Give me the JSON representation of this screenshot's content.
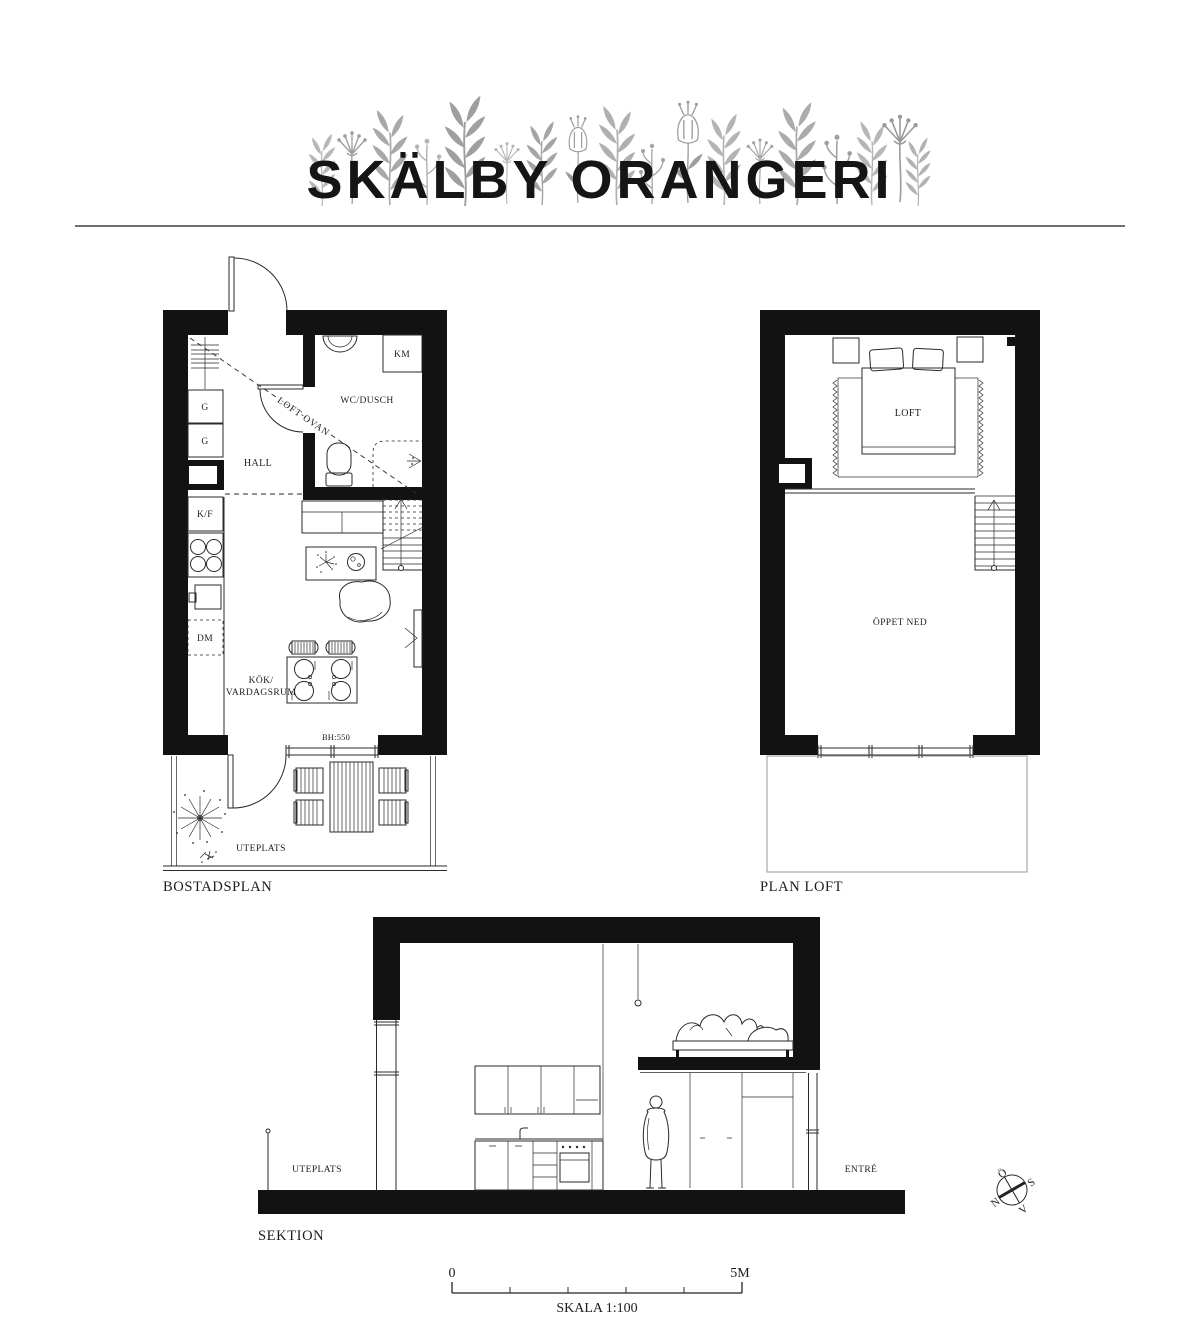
{
  "header": {
    "title": "SKÄLBY ORANGERI"
  },
  "bostadsplan": {
    "caption": "BOSTADSPLAN",
    "labels": {
      "hall": "HALL",
      "wc_dusch": "WC/DUSCH",
      "km": "KM",
      "g_upper": "G",
      "g_lower": "G",
      "kf": "K/F",
      "dm": "DM",
      "loft_ovan": "LOFT OVAN",
      "kok_line1": "KÖK/",
      "kok_line2": "VARDAGSRUM",
      "bh": "BH:550",
      "uteplats": "UTEPLATS"
    }
  },
  "plan_loft": {
    "caption": "PLAN LOFT",
    "labels": {
      "loft": "LOFT",
      "oppet_ned": "ÖPPET NED"
    }
  },
  "sektion": {
    "caption": "SEKTION",
    "labels": {
      "uteplats": "UTEPLATS",
      "entre": "ENTRÉ"
    }
  },
  "compass": {
    "north": "N",
    "south": "S",
    "east": "Ö",
    "west": "V"
  },
  "scale_bar": {
    "start": "0",
    "end": "5M",
    "caption": "SKALA 1:100"
  },
  "colors": {
    "ink": "#2a2a2a",
    "wall": "#121212",
    "light_outline": "#979797",
    "flower_gray": "#a8a8a8"
  }
}
